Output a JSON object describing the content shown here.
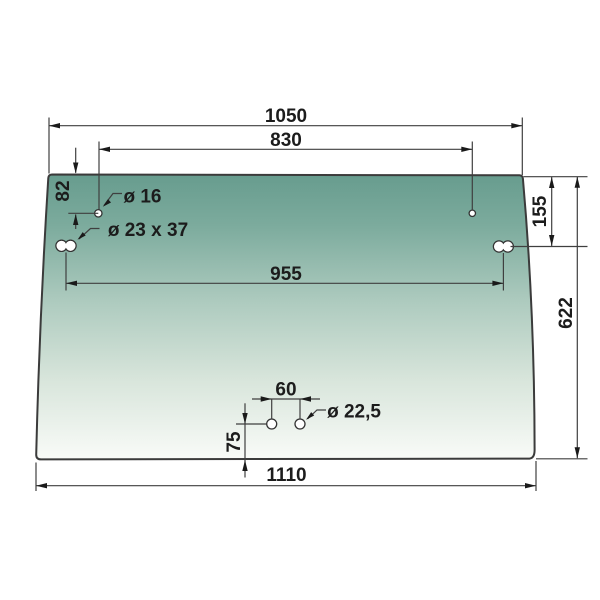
{
  "drawing": {
    "kind": "glass-panel-technical-drawing",
    "shape": "trapezoid-windshield",
    "colors": {
      "glass_gradient_top": "#679c8e",
      "glass_gradient_mid": "#aecbbf",
      "glass_gradient_bottom": "#f9fbf8",
      "outline": "#3b3b3b",
      "dimension_lines": "#3f3f3f",
      "text": "#1c1c1c",
      "background": "#ffffff"
    }
  },
  "dimensions": {
    "overall_width_top": "1050",
    "upper_holes_spacing": "830",
    "top_edge_to_upper_hole": "82",
    "upper_hole_diameter": "ø 16",
    "slot_dimensions": "ø 23 x 37",
    "slots_spacing": "955",
    "top_edge_to_slot": "155",
    "overall_height": "622",
    "lower_holes_spacing": "60",
    "lower_hole_diameter": "ø 22,5",
    "bottom_edge_to_lower_hole": "75",
    "overall_width_bottom": "1110"
  }
}
